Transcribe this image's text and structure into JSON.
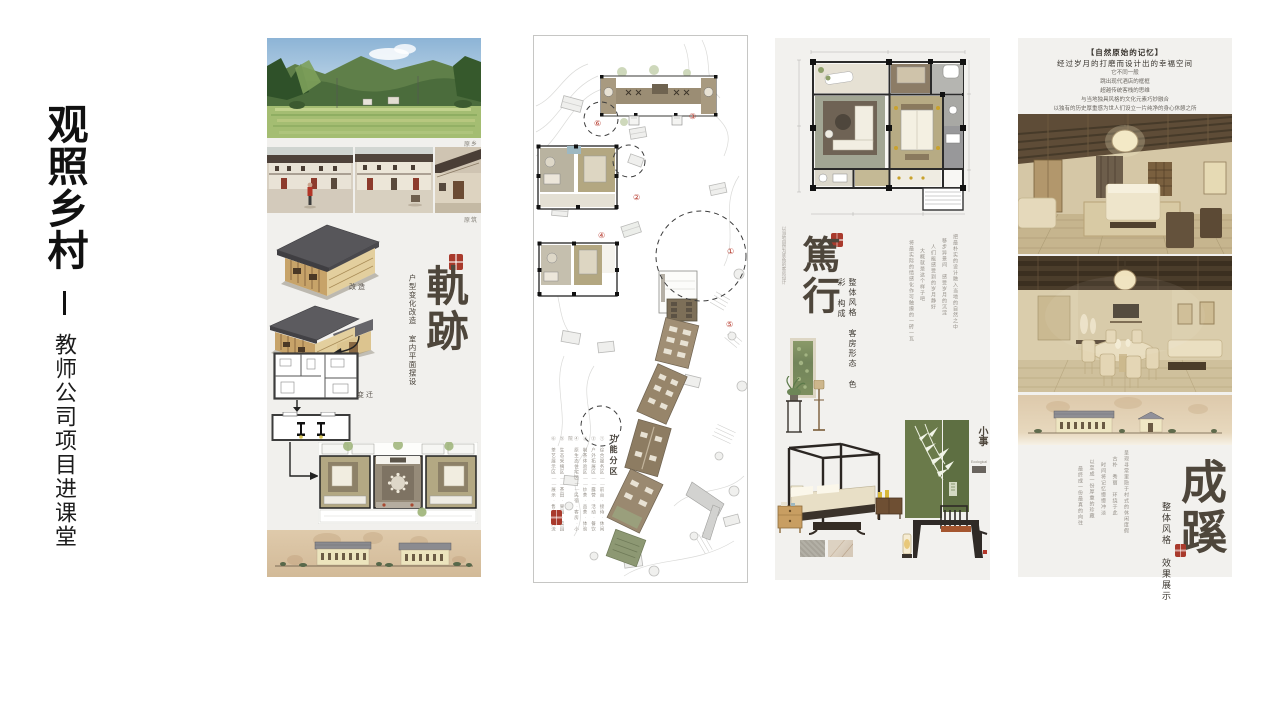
{
  "slide": {
    "background": "#ffffff",
    "accent_seal_color": "#a93a2c",
    "ink_color": "#4e463b",
    "tan_band_color": "#d9c3a5",
    "panel_bg_color": "#f2f1ee"
  },
  "left_title": {
    "main": "观照乡村",
    "dash": "—",
    "subtitle": "教师公司项目进课堂"
  },
  "panel1": {
    "photo_label_top": "原乡",
    "photo_label_row": "原筑",
    "model_label": "改造",
    "plan_label": "变迁",
    "title": "軌跡",
    "subtitle": "户型变化改造 室内平面摆设"
  },
  "panel2": {
    "legend_title": "功能分区",
    "legend_items": [
      "① 综合服务区——前台·接待·休闲",
      "② 户外拓展区——露营·活动·餐饮",
      "③ 制茶体验区——炒茶·品茶·体验",
      "④ 原生态住宅区——民宿·客房·小院",
      "⑤ 生态采摘区——茶田·果园·菜园",
      "⑥ 茶艺展示区——展示·售卖·交流"
    ],
    "markers": [
      "①",
      "②",
      "③",
      "④",
      "⑤",
      "⑥"
    ]
  },
  "panel3": {
    "title": "篤行",
    "subtitle": "整体风格 客房形态 色彩 构成",
    "side_note": "以当地自然为底色的客房设计",
    "paragraph": [
      "把最朴实的设计融入当地的自然之中",
      "移步异景间 感受岁月的沉淀",
      "人们能感受到的岁月静好",
      "大概就是这个样子吧",
      "将最实际的情感化作可触摸的一砖一瓦"
    ],
    "mini_caption": "小事",
    "mini_caption_sub": "Ecological"
  },
  "panel4": {
    "intro": [
      "【自然原始的记忆】",
      "经过岁月的打磨而设计出的幸福空间",
      "它不同一般",
      "跳出现代酒店的框框",
      "超越传统客栈的思维",
      "与当地独具风格的文化元素巧妙融合",
      "以独有的历史厚重感为世人们设立一片纯净的身心休憩之所"
    ],
    "title": "成蹊",
    "subtitle": "整体风格 效果展示",
    "paragraph": [
      "呈现寻常里隐于村式的休闲度假",
      "古朴 秀丽 环绕于此",
      "时间将记忆慢慢冲淡",
      "以至成一份厚重的珍藏",
      "最终成一份最真的向往"
    ]
  }
}
